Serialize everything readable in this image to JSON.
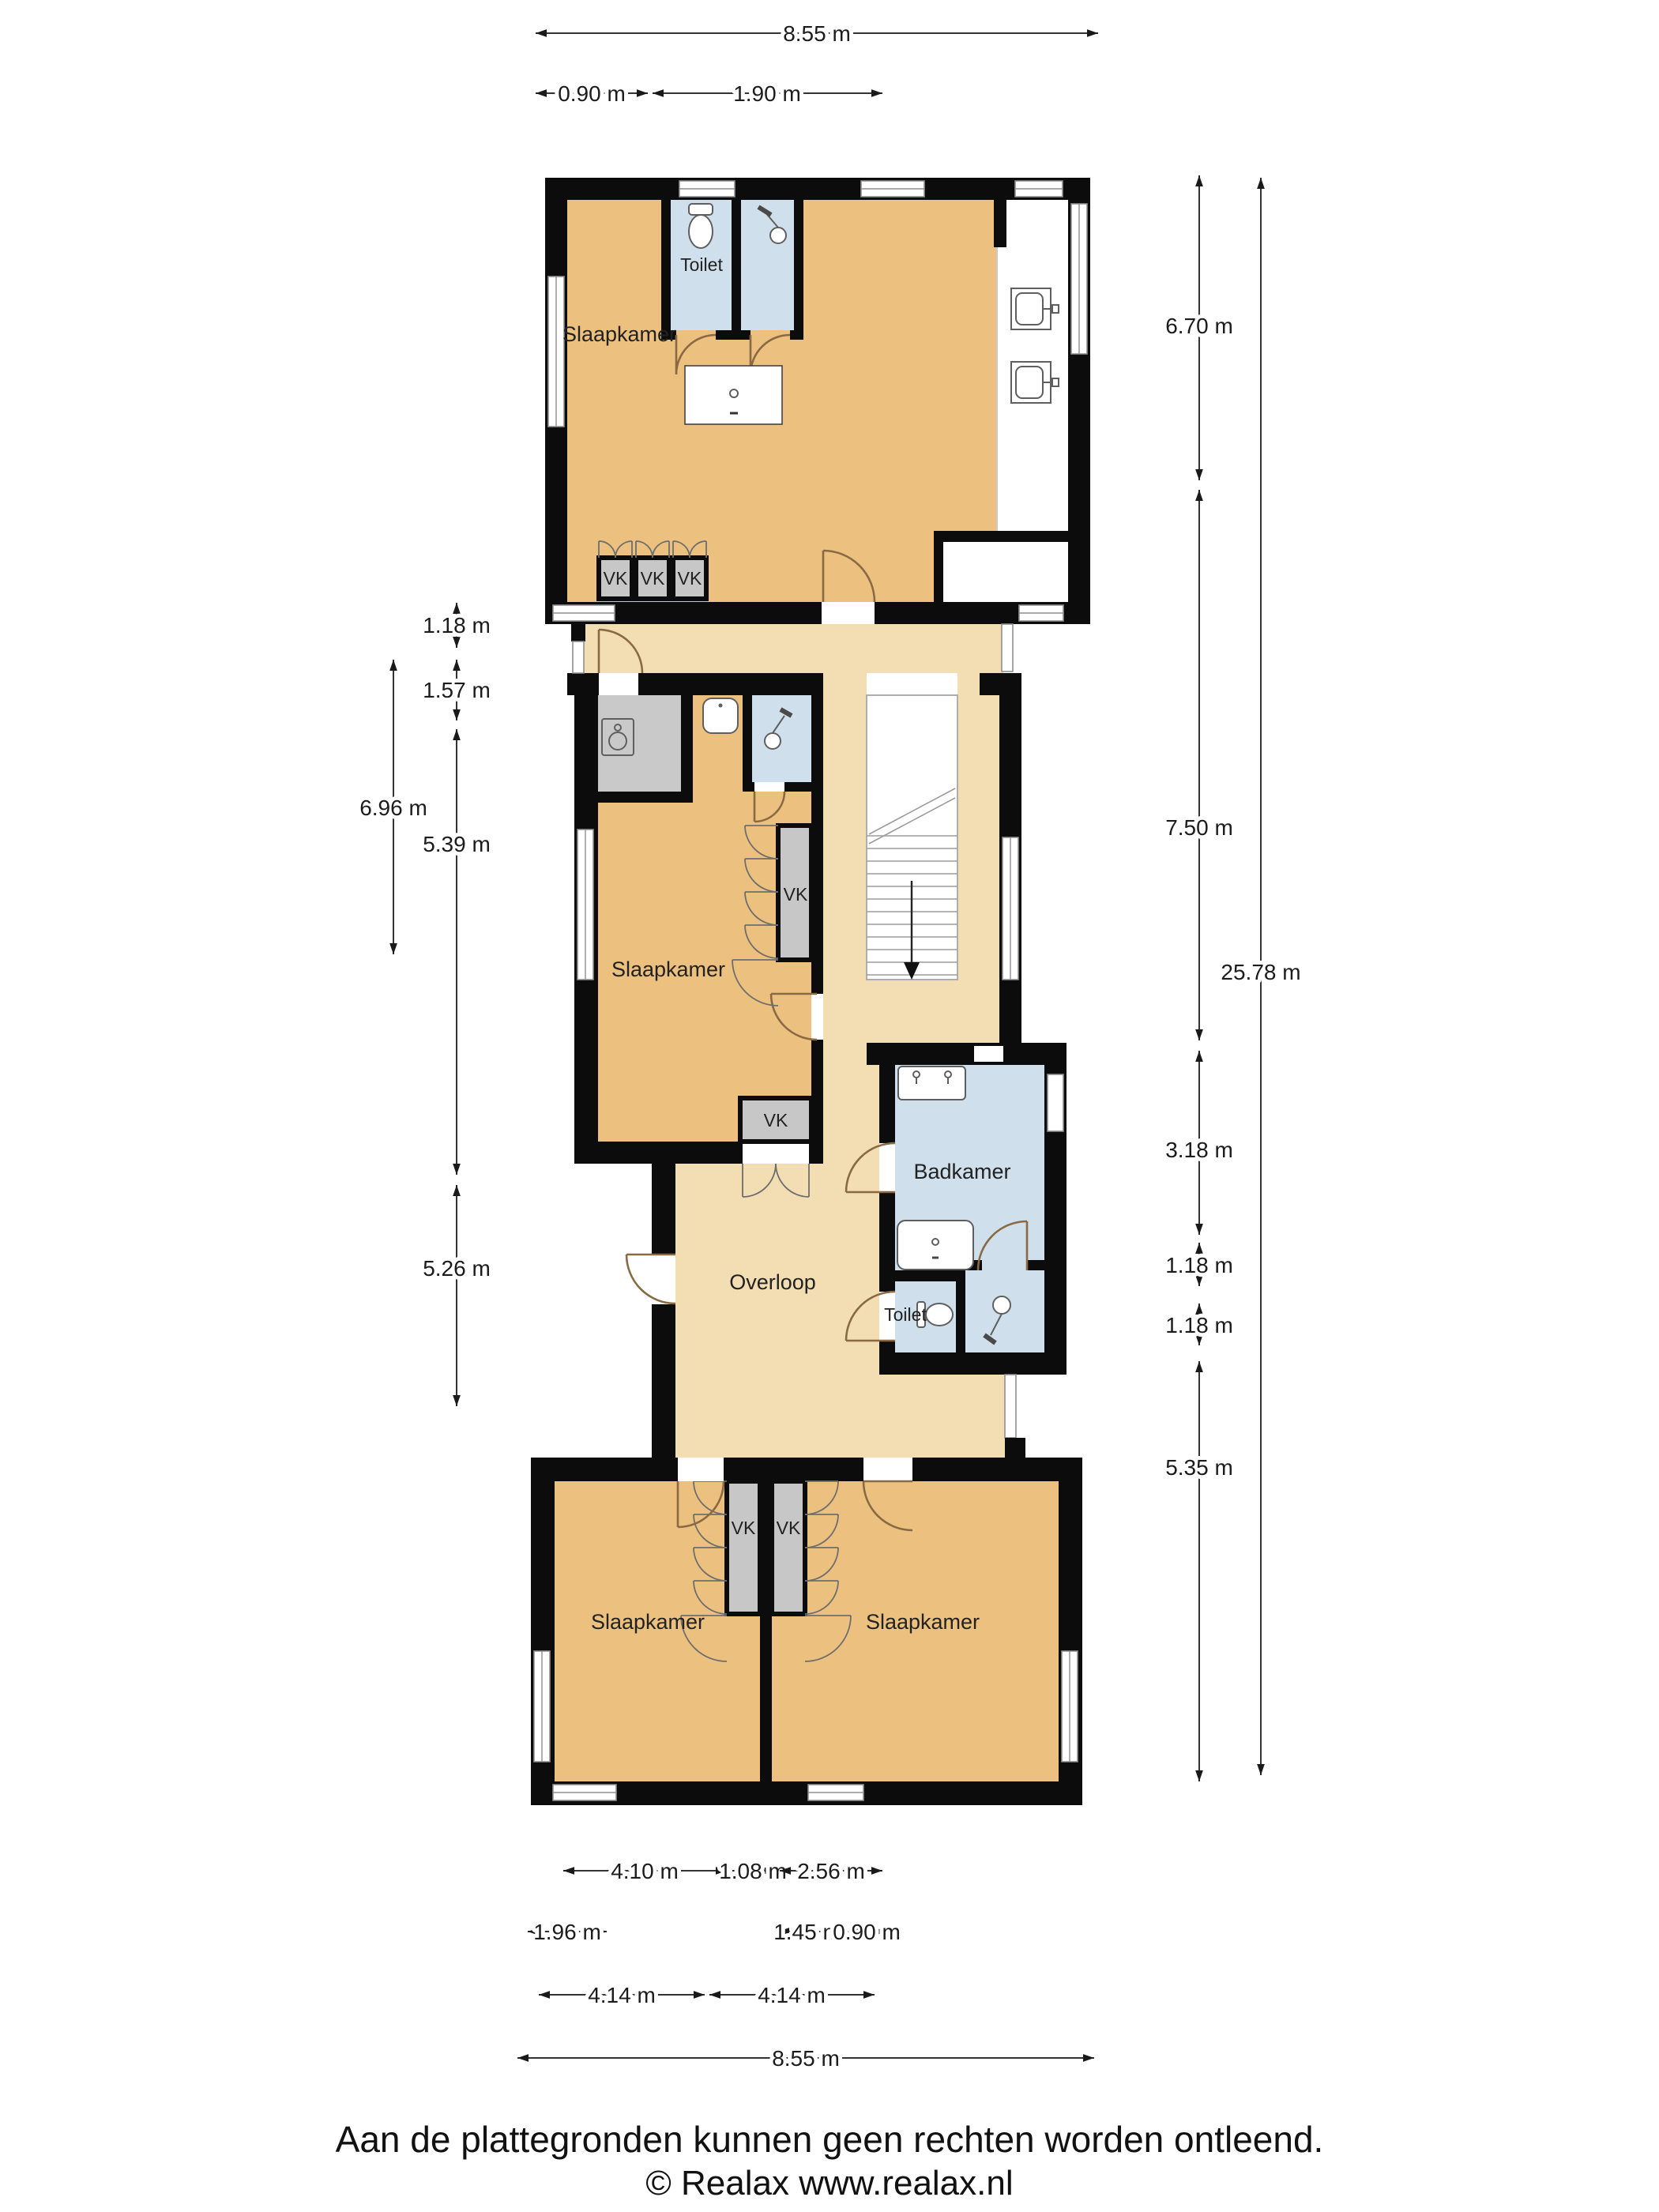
{
  "plan": {
    "rooms": {
      "bedroom_top": "Slaapkamer",
      "toilet_top": "Toilet",
      "bedroom_mid": "Slaapkamer",
      "bathroom": "Badkamer",
      "landing": "Overloop",
      "toilet_mid": "Toilet",
      "bedroom_bottom_left": "Slaapkamer",
      "bedroom_bottom_right": "Slaapkamer",
      "closet": "VK"
    },
    "colors": {
      "wall": "#0c0c0c",
      "room_floor": "#ecc07e",
      "hall_floor": "#f3ddb2",
      "wet_room": "#cfe0ec",
      "closet_fill": "#c9c9c9"
    }
  },
  "dims": {
    "top": {
      "width": "8.55 m",
      "a": "0.90 m",
      "b": "1.90 m"
    },
    "left": {
      "outer": "6.96 m",
      "segs": [
        "1.18 m",
        "1.57 m",
        "5.39 m",
        "5.26 m"
      ]
    },
    "right": {
      "outer": "25.78 m",
      "segs": [
        "6.70 m",
        "7.50 m",
        "3.18 m",
        "1.18 m",
        "1.18 m",
        "5.35 m"
      ]
    },
    "bottom": {
      "row1": [
        "4.10 m",
        "1.08 m",
        "2.56 m"
      ],
      "row2": [
        "1.96 m",
        "1.45 m",
        "0.90 m"
      ],
      "row3": [
        "4.14 m",
        "4.14 m"
      ],
      "row4": "8.55 m"
    }
  },
  "footer": {
    "line1": "Aan de plattegronden kunnen geen rechten worden ontleend.",
    "line2": "© Realax www.realax.nl"
  }
}
